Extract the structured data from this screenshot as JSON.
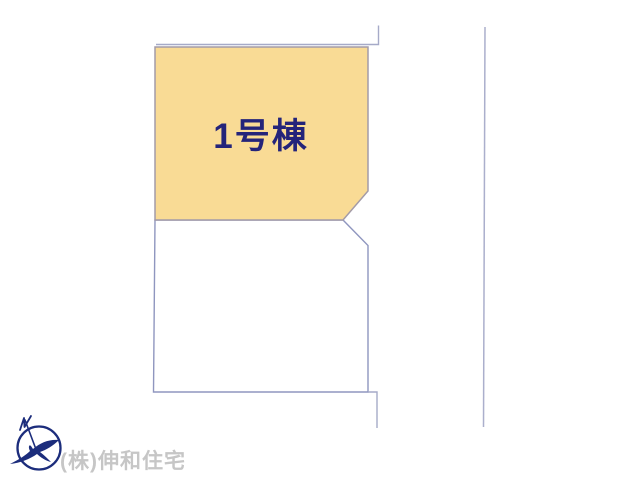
{
  "page": {
    "background": "#ffffff"
  },
  "site_plan": {
    "plots": [
      {
        "name": "plot-1",
        "label": "1号棟",
        "fill": "#f9db95",
        "label_color": "#24247a"
      },
      {
        "name": "plot-2",
        "fill": "#ffffff"
      }
    ],
    "colors": {
      "plot1_border": "#a39ba8",
      "plot2_border": "#8f96bf",
      "boundary_line": "#a6aac8",
      "road_line": "#abafcc"
    }
  },
  "footer": {
    "company_name": "(株)伸和住宅",
    "text_color": "#c6c6c6",
    "logo_icon": "bird-compass-logo",
    "logo_color": "#1c2d7c"
  }
}
